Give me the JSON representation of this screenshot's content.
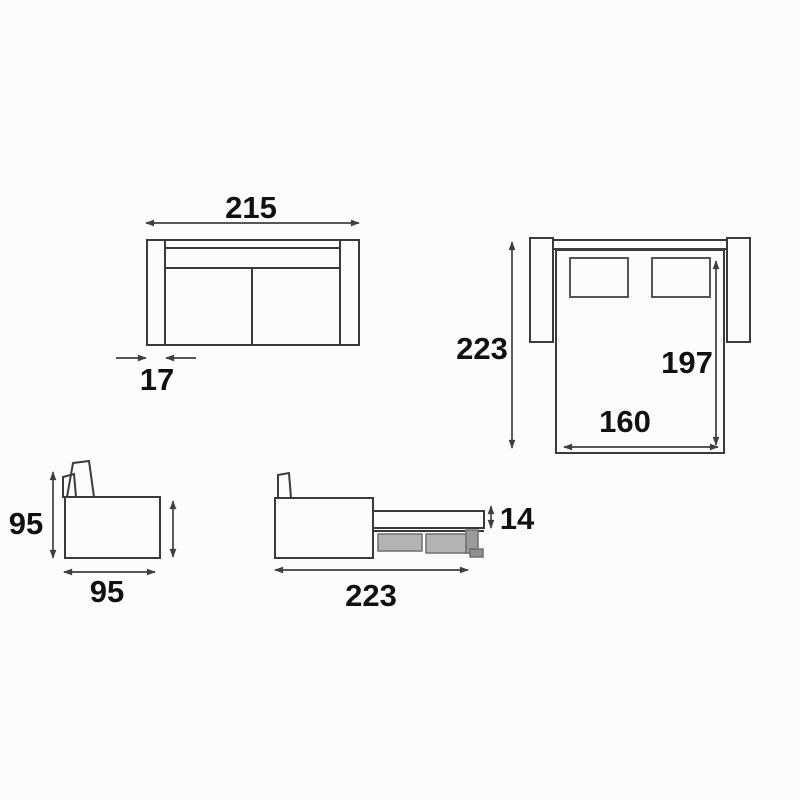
{
  "page": {
    "background_color": "#fcfcfc",
    "line_color": "#3a3a3a",
    "dimension_line_color": "#3f3f3f",
    "label_color": "#111111",
    "mechanism_fill_color": "#b3b3b3",
    "leg_fill_color": "#9b9b9b",
    "foot_fill_color": "#8f8f8f"
  },
  "views": {
    "sofa_front": {
      "name": "sofa front view (closed)",
      "overall_width": "215",
      "armrest_width": "17"
    },
    "bed_top": {
      "name": "opened sofa-bed top view",
      "overall_depth": "223",
      "mattress_length": "197",
      "mattress_width": "160"
    },
    "sofa_side": {
      "name": "sofa side view (closed)",
      "height": "95",
      "depth": "95"
    },
    "bed_side": {
      "name": "opened sofa-bed side view",
      "mattress_thickness": "14",
      "overall_depth": "223"
    }
  }
}
